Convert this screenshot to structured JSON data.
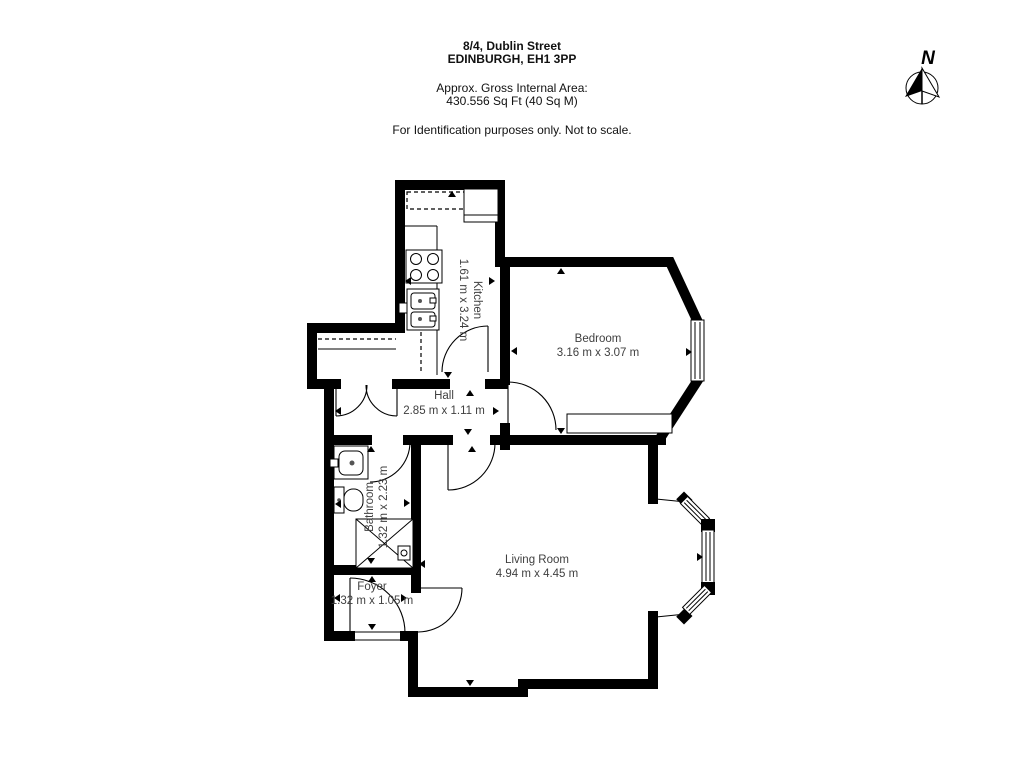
{
  "header": {
    "address_line1": "8/4, Dublin Street",
    "address_line2": "EDINBURGH, EH1 3PP",
    "area_label": "Approx. Gross Internal Area:",
    "area_value": "430.556 Sq Ft (40 Sq M)",
    "disclaimer": "For Identification purposes only. Not to scale."
  },
  "compass": {
    "label": "N"
  },
  "rooms": [
    {
      "name": "Kitchen",
      "dimensions": "1.61 m x 3.24 m",
      "orientation": "vertical"
    },
    {
      "name": "Bedroom",
      "dimensions": "3.16 m x 3.07 m",
      "orientation": "horizontal"
    },
    {
      "name": "Hall",
      "dimensions": "2.85 m x 1.11 m",
      "orientation": "horizontal"
    },
    {
      "name": "Bathroom",
      "dimensions": "1.32 m x 2.23 m",
      "orientation": "vertical"
    },
    {
      "name": "Living Room",
      "dimensions": "4.94 m x 4.45 m",
      "orientation": "horizontal"
    },
    {
      "name": "Foyer",
      "dimensions": "1.32 m x 1.05 m",
      "orientation": "horizontal"
    }
  ],
  "icons": [
    "north-arrow-icon",
    "hob-icon",
    "kitchen-sink-icon",
    "appliance-icon",
    "wash-basin-icon",
    "toilet-icon",
    "shower-icon",
    "dimension-arrow-icon",
    "door-swing-icon",
    "window-icon",
    "wardrobe-icon"
  ],
  "colors": {
    "wall": "#000000",
    "label_text": "#3f3f3f",
    "background": "#ffffff"
  }
}
